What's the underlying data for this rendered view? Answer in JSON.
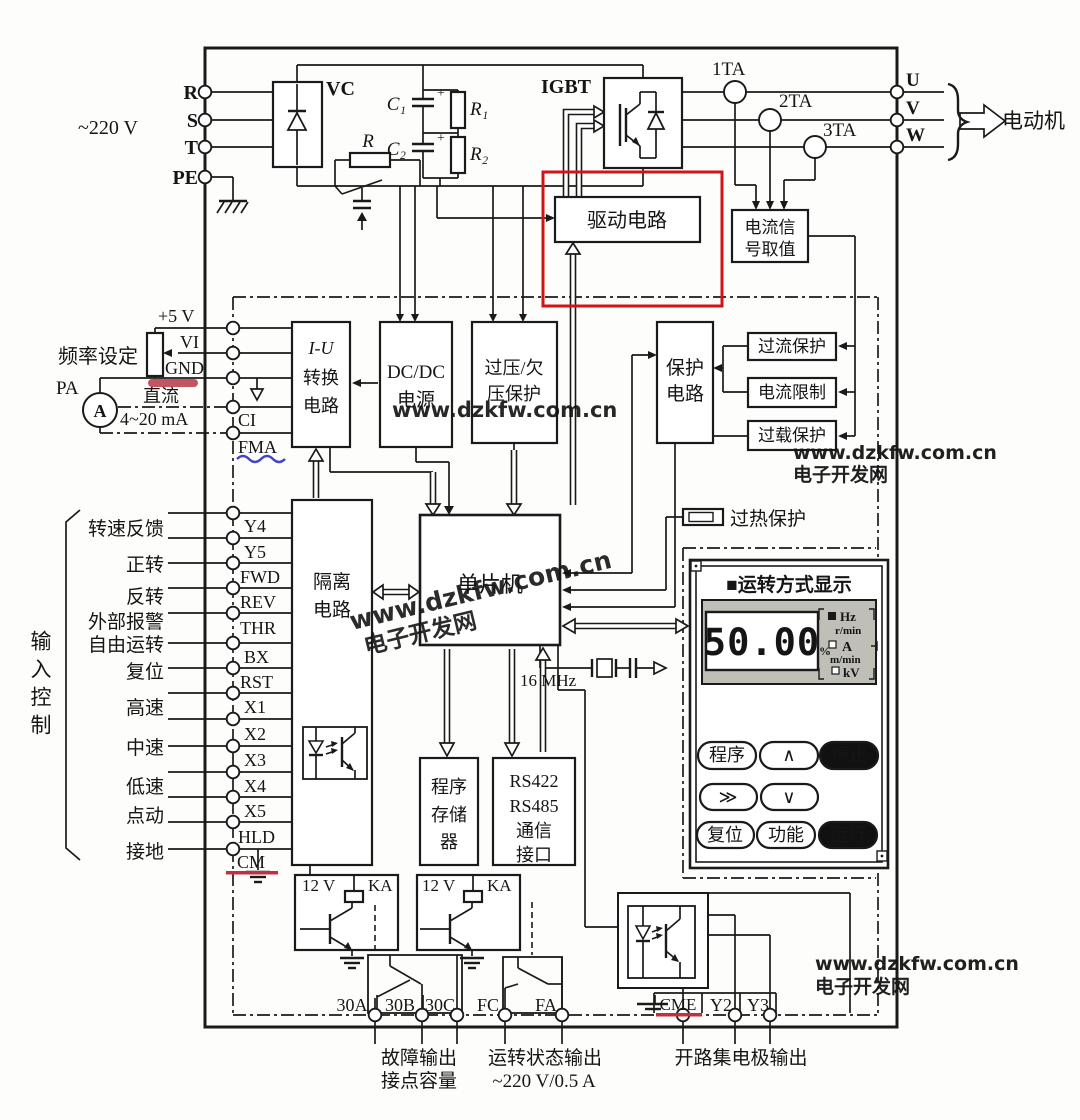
{
  "ac": {
    "voltage": "~220 V",
    "phase_r": "R",
    "phase_s": "S",
    "phase_t": "T",
    "pe": "PE"
  },
  "rect": {
    "vc": "VC",
    "r": "R",
    "c1": "C₁",
    "c2": "C₂",
    "r1": "R₁",
    "r2": "R₂",
    "plus": "+"
  },
  "inv": {
    "igbt": "IGBT",
    "ta1": "1TA",
    "ta2": "2TA",
    "ta3": "3TA",
    "u": "U",
    "v": "V",
    "w": "W",
    "motor": "电动机"
  },
  "blk": {
    "drive": "驱动电路",
    "sense1": "电流信",
    "sense2": "号取值",
    "iu1": "I-U",
    "iu2": "转换",
    "iu3": "电路",
    "dcdc1": "DC/DC",
    "dcdc2": "电源",
    "ovp1": "过压/欠",
    "ovp2": "压保护",
    "prot1": "保护",
    "prot2": "电路",
    "oc": "过流保护",
    "cl": "电流限制",
    "ol": "过载保护",
    "oh": "过热保护",
    "iso1": "隔离",
    "iso2": "电路",
    "mcu": "单片机",
    "clock": "16 MHz",
    "mem1": "程序",
    "mem2": "存储",
    "mem3": "器",
    "comm1": "RS422",
    "comm2": "RS485",
    "comm3": "通信",
    "comm4": "接口"
  },
  "ana": {
    "p5": "+5 V",
    "vi": "VI",
    "gnd": "GND",
    "ci": "CI",
    "fma": "FMA",
    "freq": "频率设定",
    "pa": "PA",
    "amp": "A",
    "dc1": "直流",
    "dc2": "4~20 mA"
  },
  "dig": {
    "group": "输入控制",
    "labels": [
      "转速反馈",
      "正转",
      "反转",
      "外部报警",
      "自由运转",
      "复位",
      "高速",
      "中速",
      "低速",
      "点动",
      "接地"
    ],
    "terms": [
      "Y4",
      "Y5",
      "FWD",
      "REV",
      "THR",
      "BX",
      "RST",
      "X1",
      "X2",
      "X3",
      "X4",
      "X5",
      "HLD",
      "CM"
    ]
  },
  "panel": {
    "title": "■运转方式显示",
    "value": "50.00",
    "pct": "%",
    "units": [
      "Hz",
      "r/min",
      "A",
      "m/min",
      "kV"
    ],
    "btns": [
      "程序",
      "∧",
      "停止",
      "≫",
      "∨",
      "复位",
      "功能",
      "运行"
    ]
  },
  "relay": {
    "v": "12 V",
    "ka": "KA"
  },
  "bot": {
    "terms": [
      "30A",
      "30B",
      "30C",
      "FC",
      "FA",
      "CME",
      "Y2",
      "Y3"
    ],
    "fault1": "故障输出",
    "fault2": "接点容量",
    "run1": "运转状态输出",
    "run2": "~220 V/0.5 A",
    "oc": "开路集电极输出"
  },
  "wm": {
    "url": "www.dzkfw.com.cn",
    "site": "电子开发网"
  },
  "colors": {
    "ink": "#1a1a1a",
    "red_box": "#d41414",
    "marker_red": "#b22a3a",
    "marker_blue": "#4343c8",
    "wm_blue": "#2323dd",
    "wm_green": "#3bc43b",
    "wm_orange": "#ff5230",
    "lcd": "#bfbfb8"
  }
}
